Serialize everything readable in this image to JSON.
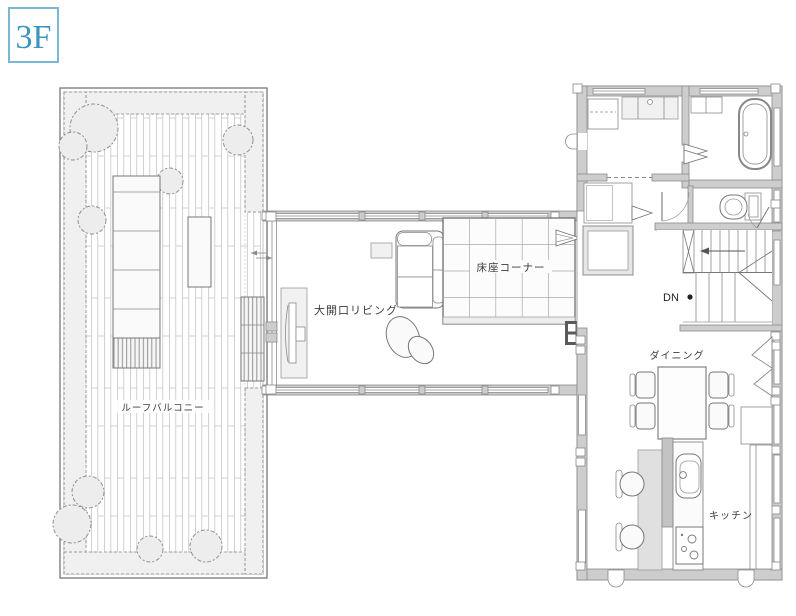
{
  "floor_badge": {
    "label": "3F"
  },
  "labels": {
    "balcony": "ルーフバルコニー",
    "living": "大開口リビング",
    "floor_seat": "床座コーナー",
    "dining": "ダイニング",
    "kitchen": "キッチン",
    "stairs_down": "DN"
  },
  "colors": {
    "badge_blue": "#3d95bd",
    "badge_border": "#7ab8d4",
    "wall_gray": "#cdcdcd",
    "line_gray": "#8a8a8a",
    "text": "#3c3c3c",
    "background": "#ffffff"
  }
}
